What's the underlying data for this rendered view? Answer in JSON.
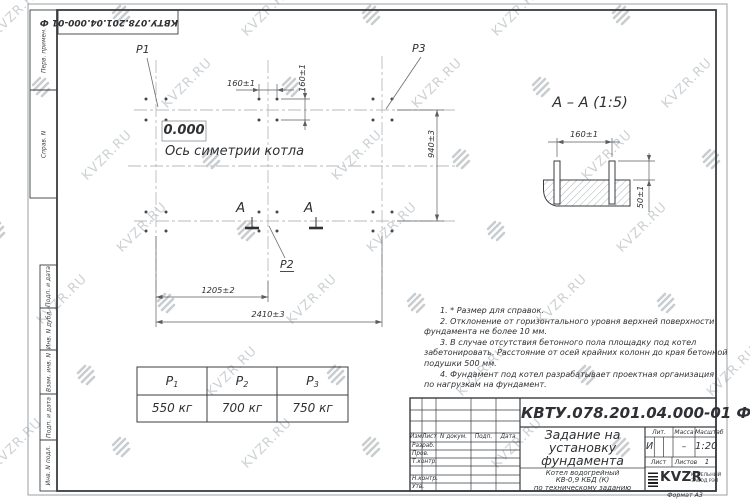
{
  "watermark": {
    "text": "KVZR.RU"
  },
  "frame": {
    "doc_box": "КВТУ.078.201.04.000-01 Ф",
    "format_note": "Формат А3",
    "margin_labels": [
      "Перв. примен.",
      "Справ. N",
      "Подп. и дата",
      "Инв. N дубл.",
      "Взам. инв. N",
      "Подп. и дата",
      "Инв. N подл."
    ]
  },
  "plan": {
    "p1": "P1",
    "p2": "P2",
    "p3": "P3",
    "level": "0.000",
    "axis_label": "Ось симетрии котла",
    "dim_bolt_h": "160±1",
    "dim_bolt_v": "160±1",
    "dim_height": "940±3",
    "dim_half": "1205±2",
    "dim_full": "2410±3",
    "section_letter_left": "A",
    "section_letter_right": "A"
  },
  "section": {
    "title": "А – А (1:5)",
    "dim_spacing": "160±1",
    "dim_protrusion": "50±1"
  },
  "notes": {
    "lines": [
      "1. * Размер для справок.",
      "2. Отклонение от горизонтального уровня верхней поверхности",
      "фундамента не более 10 мм.",
      "3. В случае отсутствия бетонного пола площадку под котел",
      "забетонировать. Расстояние от осей крайних колонн до края бетонной",
      "подушки 500 мм.",
      "4. Фундамент под котел разрабатывает проектная организация",
      "по нагрузкам на фундамент."
    ]
  },
  "load_table": {
    "columns": [
      {
        "sym": "P",
        "sub": "1",
        "value": "550 кг"
      },
      {
        "sym": "P",
        "sub": "2",
        "value": "700 кг"
      },
      {
        "sym": "P",
        "sub": "3",
        "value": "750 кг"
      }
    ]
  },
  "title_block": {
    "doc_number": "КВТУ.078.201.04.000-01 Ф",
    "title_lines": [
      "Задание на",
      "установку",
      "фундамента"
    ],
    "subtitle_lines": [
      "Котел водогрейный",
      "КВ-0,9 КБД (К)",
      "по техническому заданию"
    ],
    "header_cols": [
      "Изм.",
      "Лист",
      "N докум.",
      "Подп.",
      "Дата"
    ],
    "sign_labels": [
      "Разраб.",
      "Пров.",
      "Т.контр.",
      "Н.контр.",
      "Утв."
    ],
    "lit_label": "Лит.",
    "lit_value": "И",
    "mass_label": "Масса",
    "mass_value": "–",
    "scale_label": "Масштаб",
    "scale_value": "1:20",
    "sheet_label": "Лист",
    "sheets_label": "Листов",
    "sheets_value": "1",
    "logo": {
      "name": "KVZR",
      "line1": "КОТЕЛЬНЫЙ",
      "line2": "ЗАВОД РЭП"
    }
  },
  "colors": {
    "line_dark": "#3a3d40",
    "line_dim": "#5a5e62",
    "centerline": "#b6babd",
    "watermark": "#cdd1d4"
  }
}
